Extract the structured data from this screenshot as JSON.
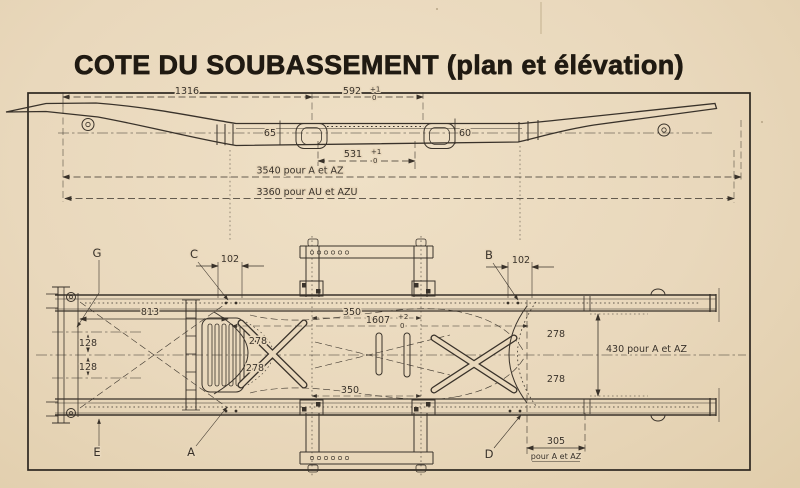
{
  "page": {
    "title": "COTE DU SOUBASSEMENT (plan et élévation)"
  },
  "colors": {
    "paper": "#e9d8bc",
    "ink": "#39322a"
  },
  "elev": {
    "d1316": "1316",
    "d592": "592",
    "d592_p": "+1",
    "d592_m": "0",
    "d65": "65",
    "d60": "60",
    "d531": "531",
    "d531_p": "+1",
    "d531_m": "0",
    "d3540": "3540 pour A et AZ",
    "d3360": "3360 pour AU et AZU"
  },
  "plan": {
    "g": "G",
    "c": "C",
    "b": "B",
    "e": "E",
    "a": "A",
    "d": "D",
    "d102_left": "102",
    "d102_right": "102",
    "d813": "813",
    "d128_upper": "128",
    "d128_lower": "128",
    "d278_left_upper": "278",
    "d278_left_lower": "278",
    "d278_right_upper": "278",
    "d278_right_lower": "278",
    "d350_upper": "350",
    "d350_lower": "350",
    "d1607": "1607",
    "d1607_p": "+2",
    "d1607_m": "0",
    "d430": "430 pour A et AZ",
    "d305": "305",
    "d305_note": "pour A et AZ"
  }
}
